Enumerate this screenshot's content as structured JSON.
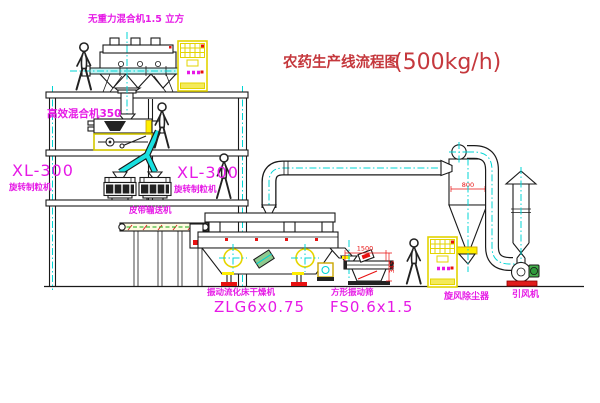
{
  "title": {
    "name": "农药生产线流程图",
    "capacity": "(500kg/h)"
  },
  "equipment": {
    "gravity_mixer": {
      "label": "无重力混合机1.5 立方"
    },
    "high_mixer": {
      "label": "高效混合机350"
    },
    "granulator_left": {
      "model": "XL-300",
      "name": "旋转制粒机"
    },
    "granulator_right": {
      "model": "XL-300",
      "name": "旋转制粒机"
    },
    "belt_conveyor": {
      "label": "皮带输送机"
    },
    "dryer": {
      "name": "振动流化床干燥机",
      "model": "ZLG6x0.75"
    },
    "sieve": {
      "name": "方形振动筛",
      "model": "FS0.6x1.5"
    },
    "cyclone": {
      "label": "旋风除尘器"
    },
    "fan": {
      "label": "引风机"
    }
  },
  "dimensions": {
    "cyclone_width": "800",
    "sieve_length": "1500",
    "sieve_height": "345"
  },
  "colors": {
    "label_magenta": "#e619e6",
    "title_red": "#c5383d",
    "dimension_red": "#e81111",
    "centerline_cyan": "#00d5d5",
    "cabinet_yellow": "#efe400",
    "structure_black": "#1a1a1a"
  }
}
